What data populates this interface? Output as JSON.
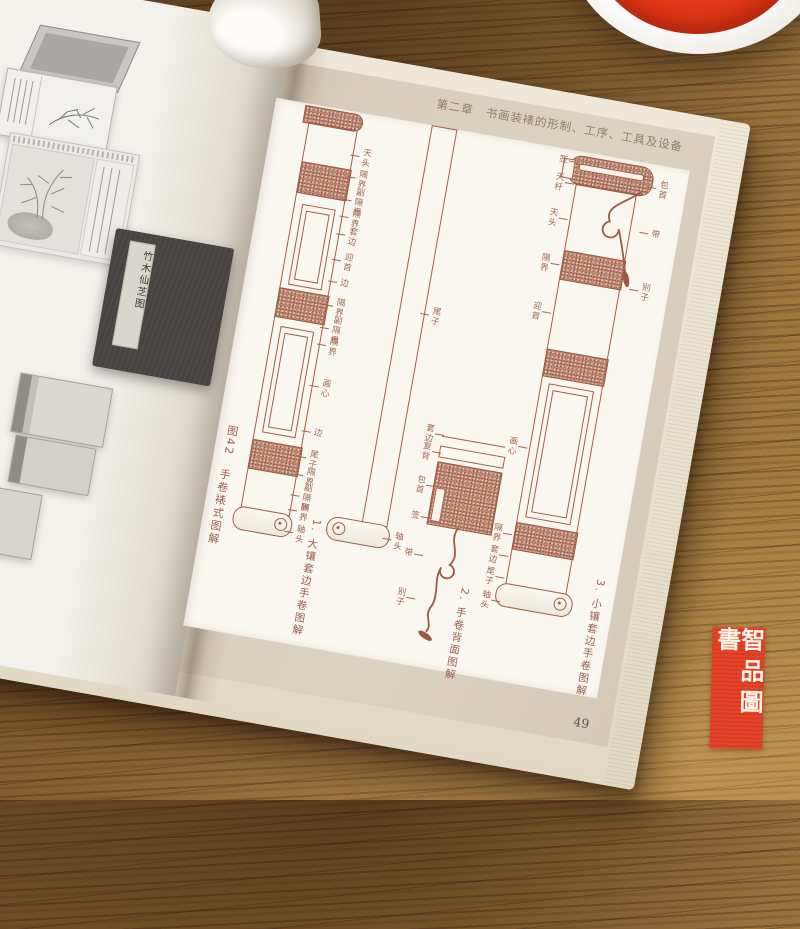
{
  "book": {
    "left_page": {
      "photos": [
        {
          "label": "open-album-with-bamboo-painting"
        },
        {
          "label": "bamboo-and-rock-artwork-with-calligraphy"
        },
        {
          "label": "closed-album-dark-cover",
          "title_slip": "竹木仙芝图"
        },
        {
          "label": "open-album-light"
        },
        {
          "label": "album-edge-partial"
        }
      ]
    },
    "right_page": {
      "header": "第二章　书画装裱的形制、工序、工具及设备",
      "page_number": "49",
      "figure": {
        "caption": "图42　手卷裱式图解",
        "diagram1": {
          "caption": "1. 大镶套边手卷图解",
          "labels": [
            "天头",
            "隔界",
            "副隔界",
            "隔界",
            "套边",
            "迎首",
            "边",
            "隔界",
            "副隔界",
            "隔界",
            "画心",
            "边",
            "尾子",
            "隔界",
            "副隔界",
            "隔界",
            "轴头"
          ]
        },
        "diagram2": {
          "caption": "2. 手卷背面图解",
          "labels": [
            "尾子",
            "轴头",
            "套边",
            "复背",
            "包首",
            "签",
            "带",
            "别子"
          ]
        },
        "diagram3": {
          "caption": "3. 小镶套边手卷图解",
          "labels_left": [
            "签",
            "天杆",
            "天头",
            "隔界",
            "迎首",
            "画心",
            "隔界",
            "套边",
            "尾子",
            "轴头"
          ],
          "labels_right": [
            "包首",
            "带",
            "别子"
          ]
        }
      }
    }
  },
  "objects": {
    "seal_paste_dish": {
      "paste_color": "#e63a18",
      "dish_color": "#f3f1ec"
    },
    "seal_stamp": {
      "text": "智品圖書",
      "background": "#dd3a1d",
      "text_color": "#fdf3e6"
    }
  },
  "colors": {
    "ink": "#9a5a44",
    "page_beige": "#d8cdbb",
    "page_white": "#f4f2ed",
    "wood": "#8a6234"
  }
}
